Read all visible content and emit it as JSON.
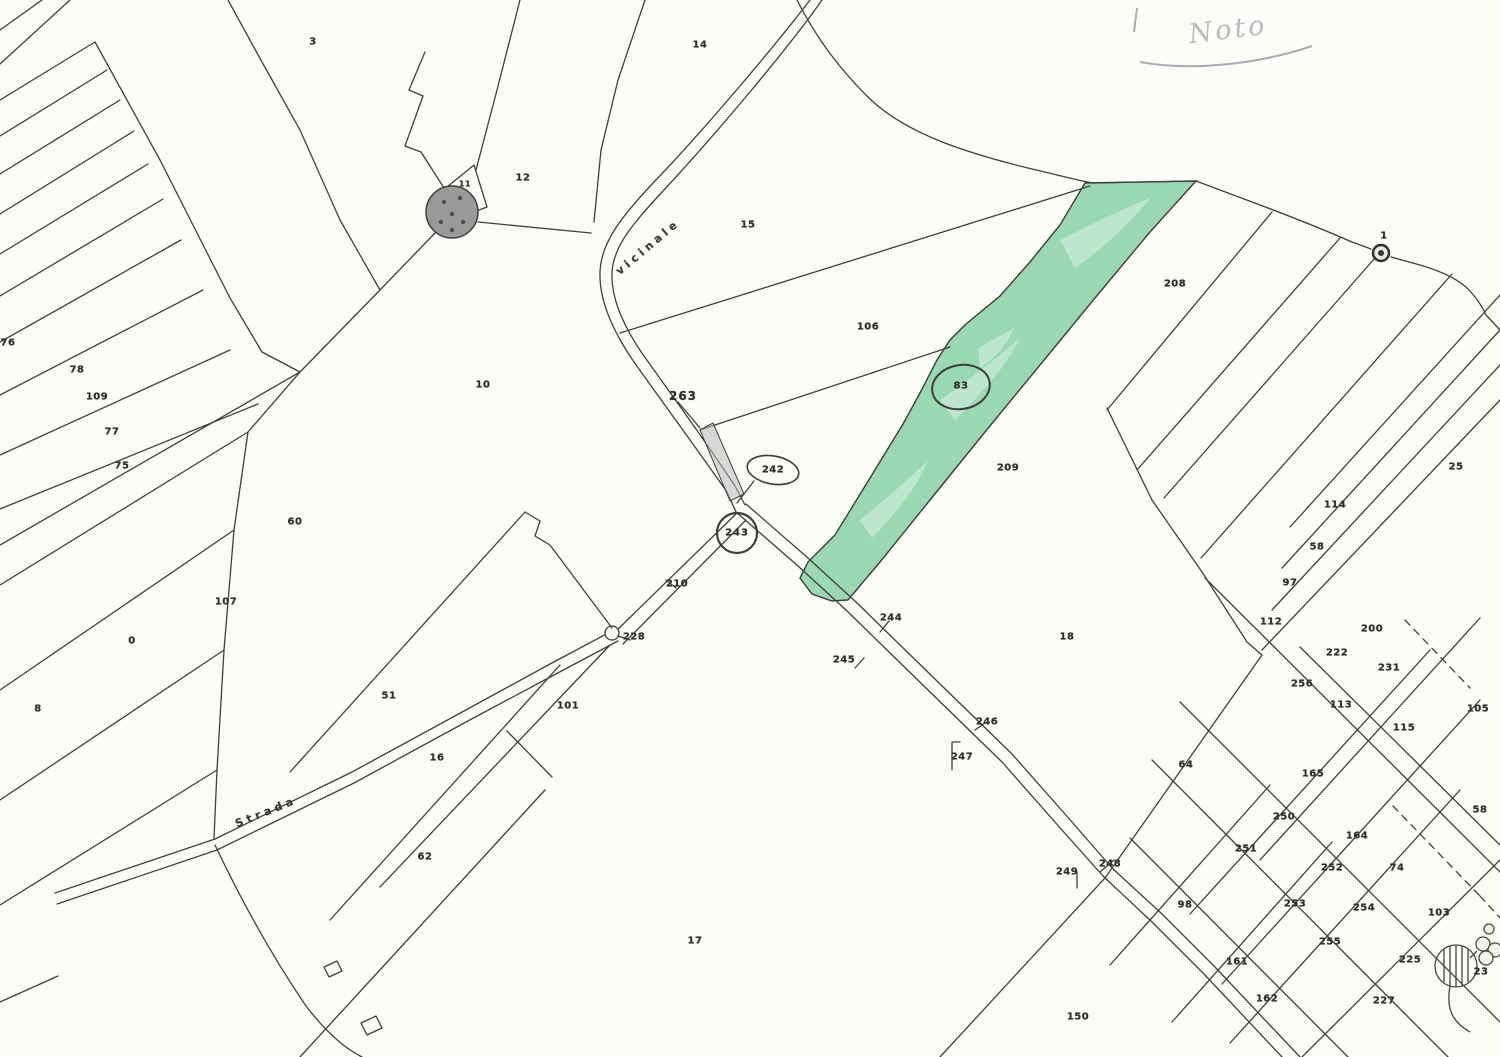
{
  "map": {
    "type": "cadastral-parcel-map",
    "annotation": {
      "text": "Noto"
    },
    "highlight_color": "#84cfa2",
    "road_labels": [
      {
        "text": "vicinale",
        "x": 648,
        "y": 247,
        "rot": -40
      },
      {
        "text": "Strada",
        "x": 266,
        "y": 812,
        "rot": -22
      }
    ],
    "circled_parcels": [
      {
        "text": "242",
        "x": 773,
        "y": 470
      },
      {
        "text": "243",
        "x": 737,
        "y": 533,
        "cls": "bold"
      },
      {
        "text": "83",
        "x": 961,
        "y": 386,
        "cls": "tiny"
      }
    ],
    "parcel_numbers": [
      {
        "text": "3",
        "x": 313,
        "y": 42
      },
      {
        "text": "14",
        "x": 700,
        "y": 45
      },
      {
        "text": "12",
        "x": 523,
        "y": 178
      },
      {
        "text": "11",
        "x": 465,
        "y": 184,
        "cls": "tiny"
      },
      {
        "text": "15",
        "x": 748,
        "y": 225
      },
      {
        "text": "10",
        "x": 483,
        "y": 385
      },
      {
        "text": "76",
        "x": 8,
        "y": 343
      },
      {
        "text": "78",
        "x": 77,
        "y": 370
      },
      {
        "text": "109",
        "x": 97,
        "y": 397
      },
      {
        "text": "77",
        "x": 112,
        "y": 432
      },
      {
        "text": "75",
        "x": 122,
        "y": 466
      },
      {
        "text": "60",
        "x": 295,
        "y": 522
      },
      {
        "text": "107",
        "x": 226,
        "y": 602
      },
      {
        "text": "0",
        "x": 132,
        "y": 641
      },
      {
        "text": "8",
        "x": 38,
        "y": 709
      },
      {
        "text": "51",
        "x": 389,
        "y": 696
      },
      {
        "text": "16",
        "x": 437,
        "y": 758
      },
      {
        "text": "101",
        "x": 568,
        "y": 706
      },
      {
        "text": "62",
        "x": 425,
        "y": 857
      },
      {
        "text": "17",
        "x": 695,
        "y": 941
      },
      {
        "text": "106",
        "x": 868,
        "y": 327
      },
      {
        "text": "209",
        "x": 1008,
        "y": 468
      },
      {
        "text": "208",
        "x": 1175,
        "y": 284
      },
      {
        "text": "18",
        "x": 1067,
        "y": 637
      },
      {
        "text": "263",
        "x": 683,
        "y": 396,
        "cls": "bold"
      },
      {
        "text": "210",
        "x": 677,
        "y": 584
      },
      {
        "text": "228",
        "x": 634,
        "y": 637
      },
      {
        "text": "244",
        "x": 891,
        "y": 618
      },
      {
        "text": "245",
        "x": 844,
        "y": 660
      },
      {
        "text": "246",
        "x": 987,
        "y": 722
      },
      {
        "text": "247",
        "x": 962,
        "y": 757
      },
      {
        "text": "248",
        "x": 1110,
        "y": 864
      },
      {
        "text": "249",
        "x": 1067,
        "y": 872
      },
      {
        "text": "1",
        "x": 1384,
        "y": 236
      },
      {
        "text": "25",
        "x": 1456,
        "y": 467
      },
      {
        "text": "114",
        "x": 1335,
        "y": 505
      },
      {
        "text": "58",
        "x": 1317,
        "y": 547
      },
      {
        "text": "97",
        "x": 1290,
        "y": 583
      },
      {
        "text": "112",
        "x": 1271,
        "y": 622
      },
      {
        "text": "200",
        "x": 1372,
        "y": 629
      },
      {
        "text": "222",
        "x": 1337,
        "y": 653
      },
      {
        "text": "231",
        "x": 1389,
        "y": 668
      },
      {
        "text": "256",
        "x": 1302,
        "y": 684
      },
      {
        "text": "113",
        "x": 1341,
        "y": 705
      },
      {
        "text": "105",
        "x": 1478,
        "y": 709
      },
      {
        "text": "115",
        "x": 1404,
        "y": 728
      },
      {
        "text": "165",
        "x": 1313,
        "y": 774
      },
      {
        "text": "58",
        "x": 1480,
        "y": 810
      },
      {
        "text": "64",
        "x": 1186,
        "y": 765
      },
      {
        "text": "250",
        "x": 1284,
        "y": 817
      },
      {
        "text": "164",
        "x": 1357,
        "y": 836
      },
      {
        "text": "251",
        "x": 1246,
        "y": 849
      },
      {
        "text": "252",
        "x": 1332,
        "y": 868
      },
      {
        "text": "74",
        "x": 1397,
        "y": 868
      },
      {
        "text": "253",
        "x": 1295,
        "y": 904
      },
      {
        "text": "254",
        "x": 1364,
        "y": 908
      },
      {
        "text": "103",
        "x": 1439,
        "y": 913
      },
      {
        "text": "255",
        "x": 1330,
        "y": 942
      },
      {
        "text": "225",
        "x": 1410,
        "y": 960
      },
      {
        "text": "23",
        "x": 1481,
        "y": 972
      },
      {
        "text": "162",
        "x": 1267,
        "y": 999
      },
      {
        "text": "227",
        "x": 1384,
        "y": 1001
      },
      {
        "text": "98",
        "x": 1185,
        "y": 905
      },
      {
        "text": "161",
        "x": 1237,
        "y": 962
      },
      {
        "text": "150",
        "x": 1078,
        "y": 1017
      }
    ]
  }
}
